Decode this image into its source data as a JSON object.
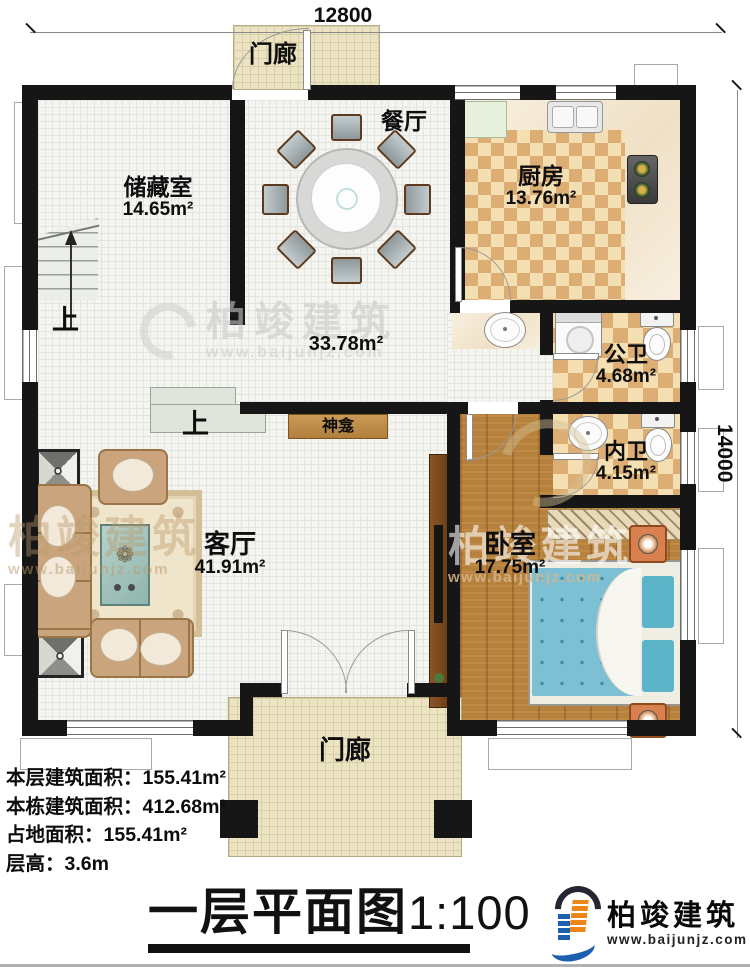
{
  "dimensions": {
    "width_top": "12800",
    "height_right": "14000"
  },
  "rooms": {
    "porch_top": {
      "name": "门廊"
    },
    "storage": {
      "name": "储藏室",
      "area": "14.65m²"
    },
    "dining": {
      "name": "餐厅"
    },
    "kitchen": {
      "name": "厨房",
      "area": "13.76m²"
    },
    "hall": {
      "area": "33.78m²"
    },
    "public_bath": {
      "name": "公卫",
      "area": "4.68m²"
    },
    "inner_bath": {
      "name": "内卫",
      "area": "4.15m²"
    },
    "living": {
      "name": "客厅",
      "area": "41.91m²"
    },
    "bedroom": {
      "name": "卧室",
      "area": "17.75m²"
    },
    "shrine": {
      "name": "神龛"
    },
    "porch_bottom": {
      "name": "门廊"
    }
  },
  "stairs": {
    "up_label_1": "上",
    "up_label_2": "上"
  },
  "info": {
    "lines": [
      "本层建筑面积：155.41m²",
      "本栋建筑面积：412.68m²",
      "占地面积：155.41m²",
      "层高：3.6m"
    ]
  },
  "title": {
    "text": "一层平面图",
    "scale": "1:100"
  },
  "logo": {
    "name": "柏竣建筑",
    "url": "www.baijunjz.com"
  },
  "watermark": {
    "name": "柏竣建筑",
    "url": "www.baijunjz.com"
  },
  "colors": {
    "wall": "#161616",
    "wood": "#b5813d",
    "checker": "#dcae74",
    "brand_blue": "#1c5fae",
    "brand_orange": "#f08519"
  }
}
